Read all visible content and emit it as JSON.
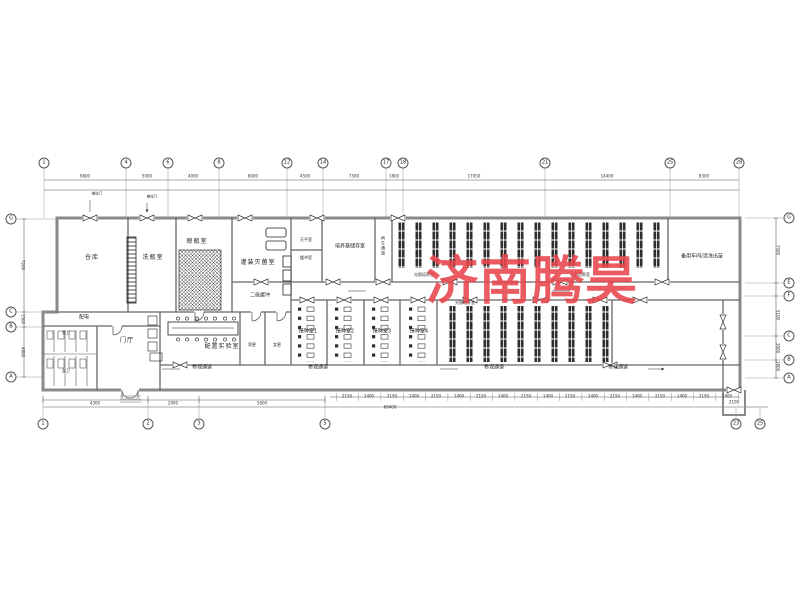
{
  "watermark": {
    "text": "济南腾昊",
    "color": "#e8464d"
  },
  "rooms": {
    "warehouse": "仓库",
    "bottle_wash": "洗瓶室",
    "bottle_dry": "晾瓶室",
    "filling_sterilize": "灌装灭菌室",
    "balance": "天平室",
    "buffer_small": "缓冲室",
    "medium_storage": "培养基储存室",
    "regen_corridor": "再生通道",
    "light_culture": "光照培养室",
    "spare_workshop": "备用车间/清洗出苗",
    "secondary_buffer": "二级缓冲",
    "prep_lab": "配置实验室",
    "inoc1": "接种室1",
    "inoc2": "接种室2",
    "inoc3": "接种室3",
    "inoc4": "接种室4",
    "male_change": "男更",
    "female_change": "女更",
    "lobby": "门厅",
    "power": "配电",
    "male_wc": "男卫",
    "female_wc": "女卫",
    "visit_corridor": "参观通道",
    "sliding_door": "推拉门"
  },
  "grid_top": [
    {
      "t": "1",
      "x": 44
    },
    {
      "t": "4",
      "x": 126
    },
    {
      "t": "6",
      "x": 168
    },
    {
      "t": "8",
      "x": 219
    },
    {
      "t": "12",
      "x": 287
    },
    {
      "t": "14",
      "x": 323
    },
    {
      "t": "17",
      "x": 386
    },
    {
      "t": "18",
      "x": 403
    },
    {
      "t": "21",
      "x": 545
    },
    {
      "t": "25",
      "x": 670
    },
    {
      "t": "28",
      "x": 739
    }
  ],
  "grid_bottom": [
    {
      "t": "1",
      "x": 43
    },
    {
      "t": "2",
      "x": 148
    },
    {
      "t": "3",
      "x": 199
    },
    {
      "t": "5",
      "x": 325
    },
    {
      "t": "23",
      "x": 736
    },
    {
      "t": "25",
      "x": 760
    }
  ],
  "grid_left": [
    {
      "t": "G",
      "y": 219
    },
    {
      "t": "C",
      "y": 312
    },
    {
      "t": "B",
      "y": 327
    },
    {
      "t": "A",
      "y": 377
    }
  ],
  "grid_right": [
    {
      "t": "G",
      "y": 218
    },
    {
      "t": "E",
      "y": 283
    },
    {
      "t": "F",
      "y": 296
    },
    {
      "t": "C",
      "y": 336
    },
    {
      "t": "B",
      "y": 360
    },
    {
      "t": "A",
      "y": 378
    }
  ],
  "dims_top": [
    {
      "t": "9800",
      "x": 85
    },
    {
      "t": "5000",
      "x": 147
    },
    {
      "t": "4000",
      "x": 193
    },
    {
      "t": "8000",
      "x": 253
    },
    {
      "t": "4500",
      "x": 305
    },
    {
      "t": "7500",
      "x": 354
    },
    {
      "t": "1800",
      "x": 394
    },
    {
      "t": "17050",
      "x": 474
    },
    {
      "t": "14400",
      "x": 607
    },
    {
      "t": "8300",
      "x": 704
    }
  ],
  "dims_left": [
    {
      "t": "7200",
      "y": 265
    },
    {
      "t": "1500",
      "y": 319
    },
    {
      "t": "4800",
      "y": 352
    }
  ],
  "dims_right": [
    {
      "t": "7500",
      "y": 250
    },
    {
      "t": "5100",
      "y": 315
    },
    {
      "t": "3000",
      "y": 348
    },
    {
      "t": "1800",
      "y": 366
    }
  ],
  "dims_bottom_left": [
    {
      "t": "4300",
      "x": 95
    },
    {
      "t": "2000",
      "x": 173
    },
    {
      "t": "5600",
      "x": 262
    }
  ],
  "dims_bottom_ticks": [
    {
      "t": "2150",
      "x": 347
    },
    {
      "t": "1400",
      "x": 369
    },
    {
      "t": "2150",
      "x": 392
    },
    {
      "t": "1400",
      "x": 414
    },
    {
      "t": "2150",
      "x": 436
    },
    {
      "t": "1400",
      "x": 459
    },
    {
      "t": "2150",
      "x": 481
    },
    {
      "t": "1400",
      "x": 503
    },
    {
      "t": "2150",
      "x": 526
    },
    {
      "t": "1400",
      "x": 548
    },
    {
      "t": "2150",
      "x": 570
    },
    {
      "t": "1400",
      "x": 593
    },
    {
      "t": "2150",
      "x": 615
    },
    {
      "t": "1400",
      "x": 637
    },
    {
      "t": "2150",
      "x": 660
    },
    {
      "t": "1400",
      "x": 682
    },
    {
      "t": "2150",
      "x": 704
    },
    {
      "t": "1400",
      "x": 727
    }
  ],
  "dims_totals": [
    {
      "t": "68400",
      "x": 390,
      "y": 407
    },
    {
      "t": "2100",
      "x": 734,
      "y": 402
    }
  ]
}
